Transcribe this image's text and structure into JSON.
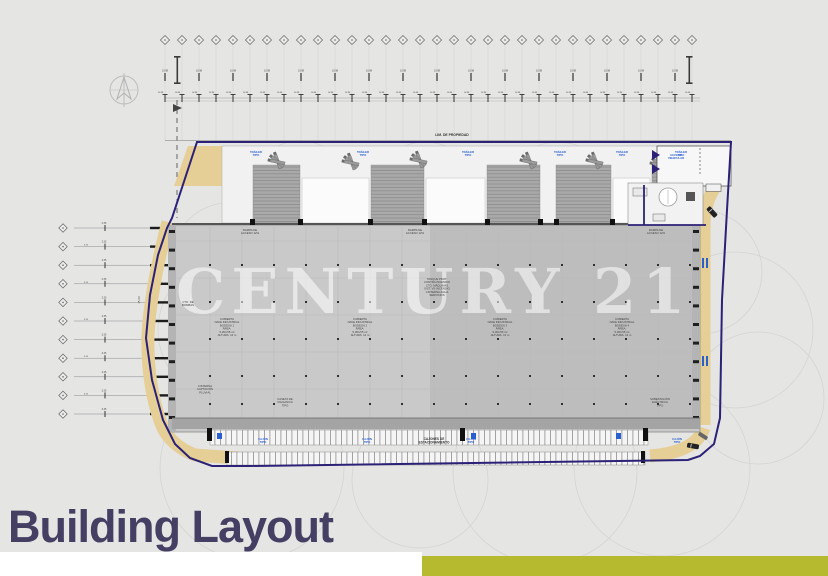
{
  "colors": {
    "background": "#e5e5e4",
    "title": "#454063",
    "accent": "#b6ba2f",
    "boundary": "#2b2176",
    "road": "#e6cf96",
    "floor": "#c9c9c9",
    "blue_label": "#2a5fd0",
    "watermark": "rgba(255,255,255,0.55)"
  },
  "title": {
    "text": "Building Layout"
  },
  "watermark": {
    "text": "CENTURY 21"
  },
  "plan": {
    "property_line_label": "LIM. DE PROPIEDAD",
    "ramp_box_label": "113",
    "gate_label_lines": [
      "ACCESO",
      "VEHICULAR"
    ],
    "dim_label": "10.98",
    "left_dim_label": "3.35",
    "road_dim_label": "15.00",
    "floor_labels": [
      {
        "x": 227,
        "y": 320,
        "lines": [
          "CUBIERTA",
          "NAVE INDUSTRIAL",
          "BODEGA 1",
          "ÁREA:",
          "5,364.55 m²",
          "ALTURA: 12 m"
        ]
      },
      {
        "x": 360,
        "y": 320,
        "lines": [
          "CUBIERTA",
          "NAVE INDUSTRIAL",
          "BODEGA 2",
          "ÁREA:",
          "5,364.55 m²",
          "ALTURA: 12 m"
        ]
      },
      {
        "x": 500,
        "y": 320,
        "lines": [
          "CUBIERTA",
          "NAVE INDUSTRIAL",
          "BODEGA 3",
          "ÁREA:",
          "5,364.55 m²",
          "ALTURA: 12 m"
        ]
      },
      {
        "x": 622,
        "y": 320,
        "lines": [
          "CUBIERTA",
          "NAVE INDUSTRIAL",
          "BODEGA 4",
          "ÁREA:",
          "5,364.55 m²",
          "ALTURA: 12 m"
        ]
      },
      {
        "x": 437,
        "y": 280,
        "lines": [
          "TANQUE PROT.",
          "CONTRA INCENDIO",
          "CTO. MÁQUINAS",
          "SIST. VS INCENDIO",
          "CISTERNA AGUA",
          "SERVICIOS"
        ]
      },
      {
        "x": 188,
        "y": 303,
        "lines": [
          "CTO. DE",
          "BOMBAS"
        ]
      },
      {
        "x": 205,
        "y": 387,
        "lines": [
          "CISTERNA",
          "CAPTACIÓN",
          "PLUVIAL"
        ]
      },
      {
        "x": 285,
        "y": 400,
        "lines": [
          "CASETA DE",
          "VIGILANCIA",
          "TIPO"
        ]
      },
      {
        "x": 660,
        "y": 400,
        "lines": [
          "SUBESTACIÓN",
          "ELÉCTRICA",
          "TIPO"
        ]
      },
      {
        "x": 250,
        "y": 231,
        "lines": [
          "RAMPA DE",
          "ACCESO 12%"
        ]
      },
      {
        "x": 415,
        "y": 231,
        "lines": [
          "RAMPA DE",
          "ACCESO 12%"
        ]
      },
      {
        "x": 656,
        "y": 231,
        "lines": [
          "RAMPA DE",
          "ACCESO 12%"
        ]
      }
    ],
    "blue_labels": {
      "dock": {
        "xs": [
          256,
          363,
          468,
          560,
          622,
          681
        ],
        "y": 153,
        "lines": [
          "TRÁILER",
          "TIPO"
        ]
      },
      "parking": {
        "xs": [
          263,
          367,
          471,
          677
        ],
        "y": 440,
        "lines": [
          "CAJÓN",
          "TIPO"
        ]
      }
    },
    "parking_center_label": {
      "x": 434,
      "y": 440,
      "lines": [
        "CAJONES DE",
        "ESTACIONAMIENTO"
      ]
    },
    "grid": {
      "top": {
        "count": 32,
        "start_x": 165,
        "step": 17,
        "y": 40
      },
      "left": {
        "count": 11,
        "x": 63,
        "start_y": 228,
        "step": 18.6
      }
    }
  }
}
